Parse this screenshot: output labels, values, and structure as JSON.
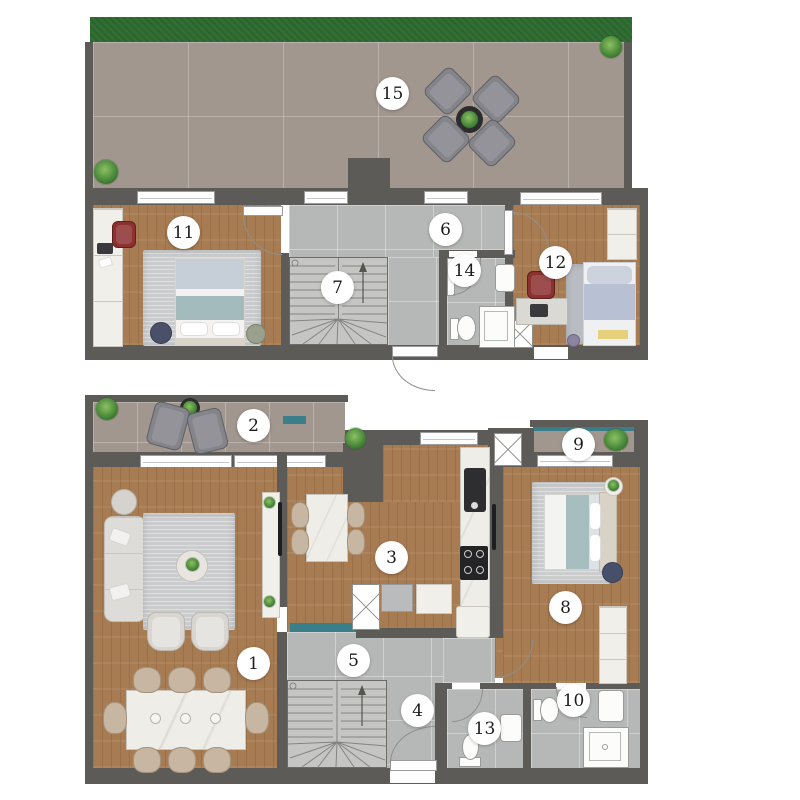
{
  "plan": {
    "title_present": false,
    "room_labels": {
      "r1": "1",
      "r2": "2",
      "r3": "3",
      "r4": "4",
      "r5": "5",
      "r6": "6",
      "r7": "7",
      "r8": "8",
      "r9": "9",
      "r10": "10",
      "r11": "11",
      "r12": "12",
      "r13": "13",
      "r14": "14",
      "r15": "15"
    },
    "colors": {
      "wall": "#5d5b58",
      "wood": "#a87c52",
      "terrace-tile": "#a2978f",
      "cool-tile": "#b6b8b7",
      "grass": "#316e33",
      "glass": "#3a7e8a",
      "chair-red": "#8c3030",
      "accent-yellow": "#e6d07c",
      "furniture-gray": "#84848b",
      "rug": "#cacccd",
      "label-bg": "#ffffff"
    }
  }
}
